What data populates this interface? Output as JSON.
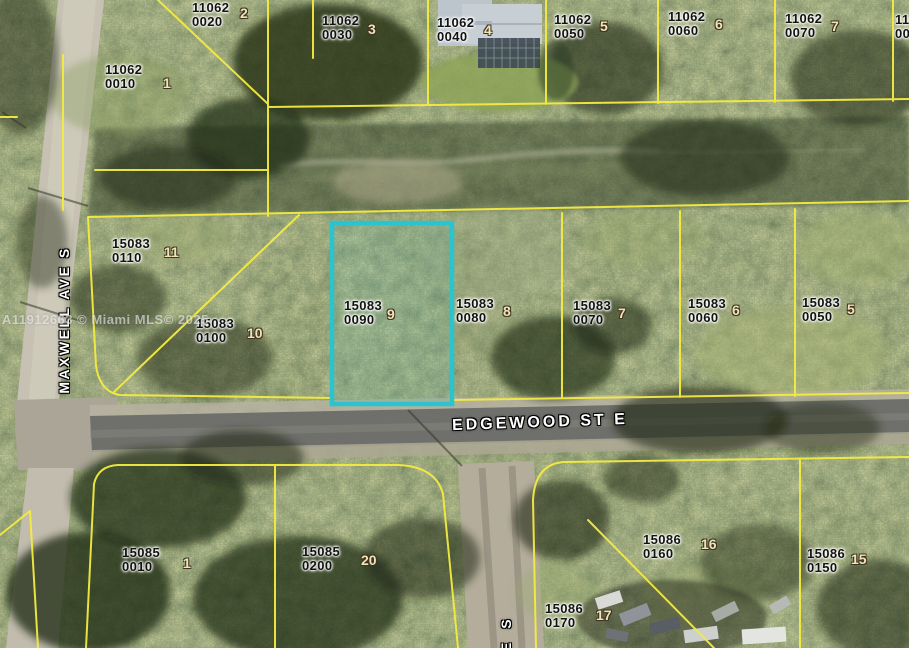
{
  "map": {
    "watermark": "A11912663 © Miami MLS© 2025",
    "streets": {
      "left_vertical": "MAXWELL AVE S",
      "main_horizontal": "EDGEWOOD ST E",
      "bottom_partial": "E S"
    },
    "colors": {
      "parcel_line": "#f3eb40",
      "highlight": "#2ac4cf"
    },
    "highlighted_parcel": {
      "block": "15083",
      "folio": "0090",
      "lot": "9"
    },
    "parcels": [
      {
        "block": "11062",
        "folio": "0010",
        "lot": "1",
        "x": 105,
        "y": 63,
        "lot_x": 163,
        "lot_y": 76
      },
      {
        "block": "11062",
        "folio": "0020",
        "lot": "2",
        "x": 192,
        "y": 1,
        "lot_x": 240,
        "lot_y": 6
      },
      {
        "block": "11062",
        "folio": "0030",
        "lot": "3",
        "x": 322,
        "y": 14,
        "lot_x": 368,
        "lot_y": 22
      },
      {
        "block": "11062",
        "folio": "0040",
        "lot": "4",
        "x": 437,
        "y": 16,
        "lot_x": 484,
        "lot_y": 23
      },
      {
        "block": "11062",
        "folio": "0050",
        "lot": "5",
        "x": 554,
        "y": 13,
        "lot_x": 600,
        "lot_y": 19
      },
      {
        "block": "11062",
        "folio": "0060",
        "lot": "6",
        "x": 668,
        "y": 10,
        "lot_x": 715,
        "lot_y": 17
      },
      {
        "block": "11062",
        "folio": "0070",
        "lot": "7",
        "x": 785,
        "y": 12,
        "lot_x": 831,
        "lot_y": 19
      },
      {
        "block": "11062",
        "folio": "00",
        "lot": "",
        "x": 895,
        "y": 13,
        "lot_x": 0,
        "lot_y": 0
      },
      {
        "block": "15083",
        "folio": "0110",
        "lot": "11",
        "x": 112,
        "y": 237,
        "lot_x": 164,
        "lot_y": 245
      },
      {
        "block": "15083",
        "folio": "0100",
        "lot": "10",
        "x": 196,
        "y": 317,
        "lot_x": 247,
        "lot_y": 326
      },
      {
        "block": "15083",
        "folio": "0090",
        "lot": "9",
        "x": 344,
        "y": 299,
        "lot_x": 387,
        "lot_y": 307,
        "highlighted": true
      },
      {
        "block": "15083",
        "folio": "0080",
        "lot": "8",
        "x": 456,
        "y": 297,
        "lot_x": 503,
        "lot_y": 304
      },
      {
        "block": "15083",
        "folio": "0070",
        "lot": "7",
        "x": 573,
        "y": 299,
        "lot_x": 618,
        "lot_y": 306
      },
      {
        "block": "15083",
        "folio": "0060",
        "lot": "6",
        "x": 688,
        "y": 297,
        "lot_x": 732,
        "lot_y": 303
      },
      {
        "block": "15083",
        "folio": "0050",
        "lot": "5",
        "x": 802,
        "y": 296,
        "lot_x": 847,
        "lot_y": 302
      },
      {
        "block": "15085",
        "folio": "0010",
        "lot": "1",
        "x": 122,
        "y": 546,
        "lot_x": 183,
        "lot_y": 556
      },
      {
        "block": "15085",
        "folio": "0200",
        "lot": "20",
        "x": 302,
        "y": 545,
        "lot_x": 361,
        "lot_y": 553
      },
      {
        "block": "15086",
        "folio": "0160",
        "lot": "16",
        "x": 643,
        "y": 533,
        "lot_x": 701,
        "lot_y": 537
      },
      {
        "block": "15086",
        "folio": "0150",
        "lot": "15",
        "x": 807,
        "y": 547,
        "lot_x": 851,
        "lot_y": 552
      },
      {
        "block": "15086",
        "folio": "0170",
        "lot": "17",
        "x": 545,
        "y": 602,
        "lot_x": 596,
        "lot_y": 608
      }
    ]
  }
}
